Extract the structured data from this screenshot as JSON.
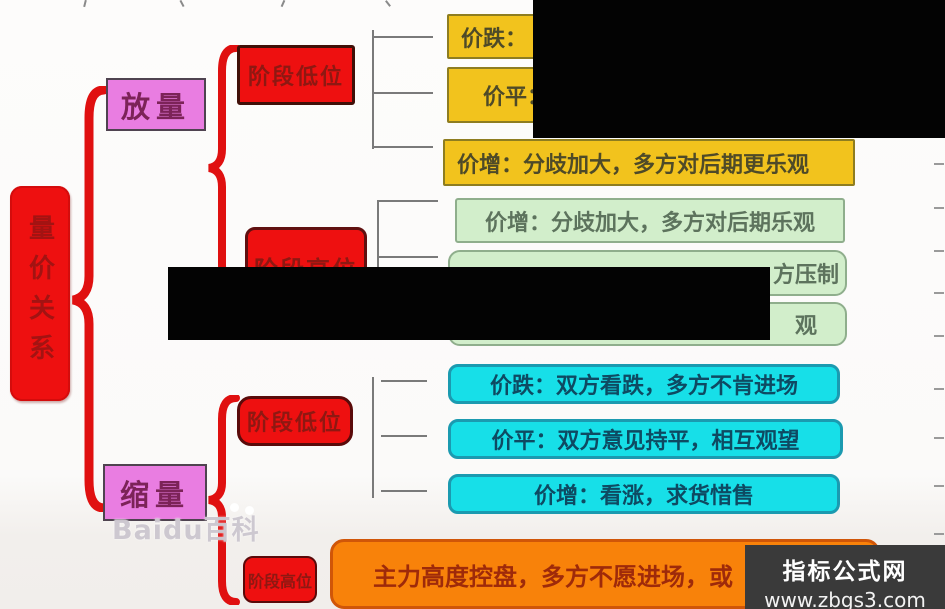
{
  "root": {
    "label": "量价关系"
  },
  "branches": {
    "top": {
      "label": "放量"
    },
    "bottom": {
      "label": "缩量"
    }
  },
  "stages": {
    "s1": {
      "label": "阶段低位"
    },
    "s2": {
      "label": "阶段高位"
    },
    "s3": {
      "label": "阶段低位"
    },
    "s4": {
      "label": "阶段高位"
    }
  },
  "yellow_boxes": {
    "b1": "价跌：",
    "b2": "价平：",
    "b3": "价增：分歧加大，多方对后期更乐观"
  },
  "green_boxes": {
    "b1": "价增：分歧加大，多方对后期乐观",
    "b2_visible_fragment": "方压制",
    "b3_visible_fragment": "观"
  },
  "cyan_boxes": {
    "b1": "价跌：双方看跌，多方不肯进场",
    "b2": "价平：双方意见持平，相互观望",
    "b3": "价增：看涨，求货惜售"
  },
  "orange_box": {
    "text": "主力高度控盘，多方不愿进场，或"
  },
  "watermarks": {
    "baidu": "Baidu百科",
    "site_name": "指标公式网",
    "site_url": "www.zbgs3.com"
  },
  "colors": {
    "node_red": "#ee1010",
    "node_pink": "#e97de1",
    "leaf_yellow": "#f2c31d",
    "leaf_green": "#d2eecb",
    "leaf_cyan": "#17dfe8",
    "leaf_orange": "#f8820a",
    "brace_red": "#e01010",
    "redaction_black": "#030303",
    "watermark_gray": "#3a3a3a"
  }
}
